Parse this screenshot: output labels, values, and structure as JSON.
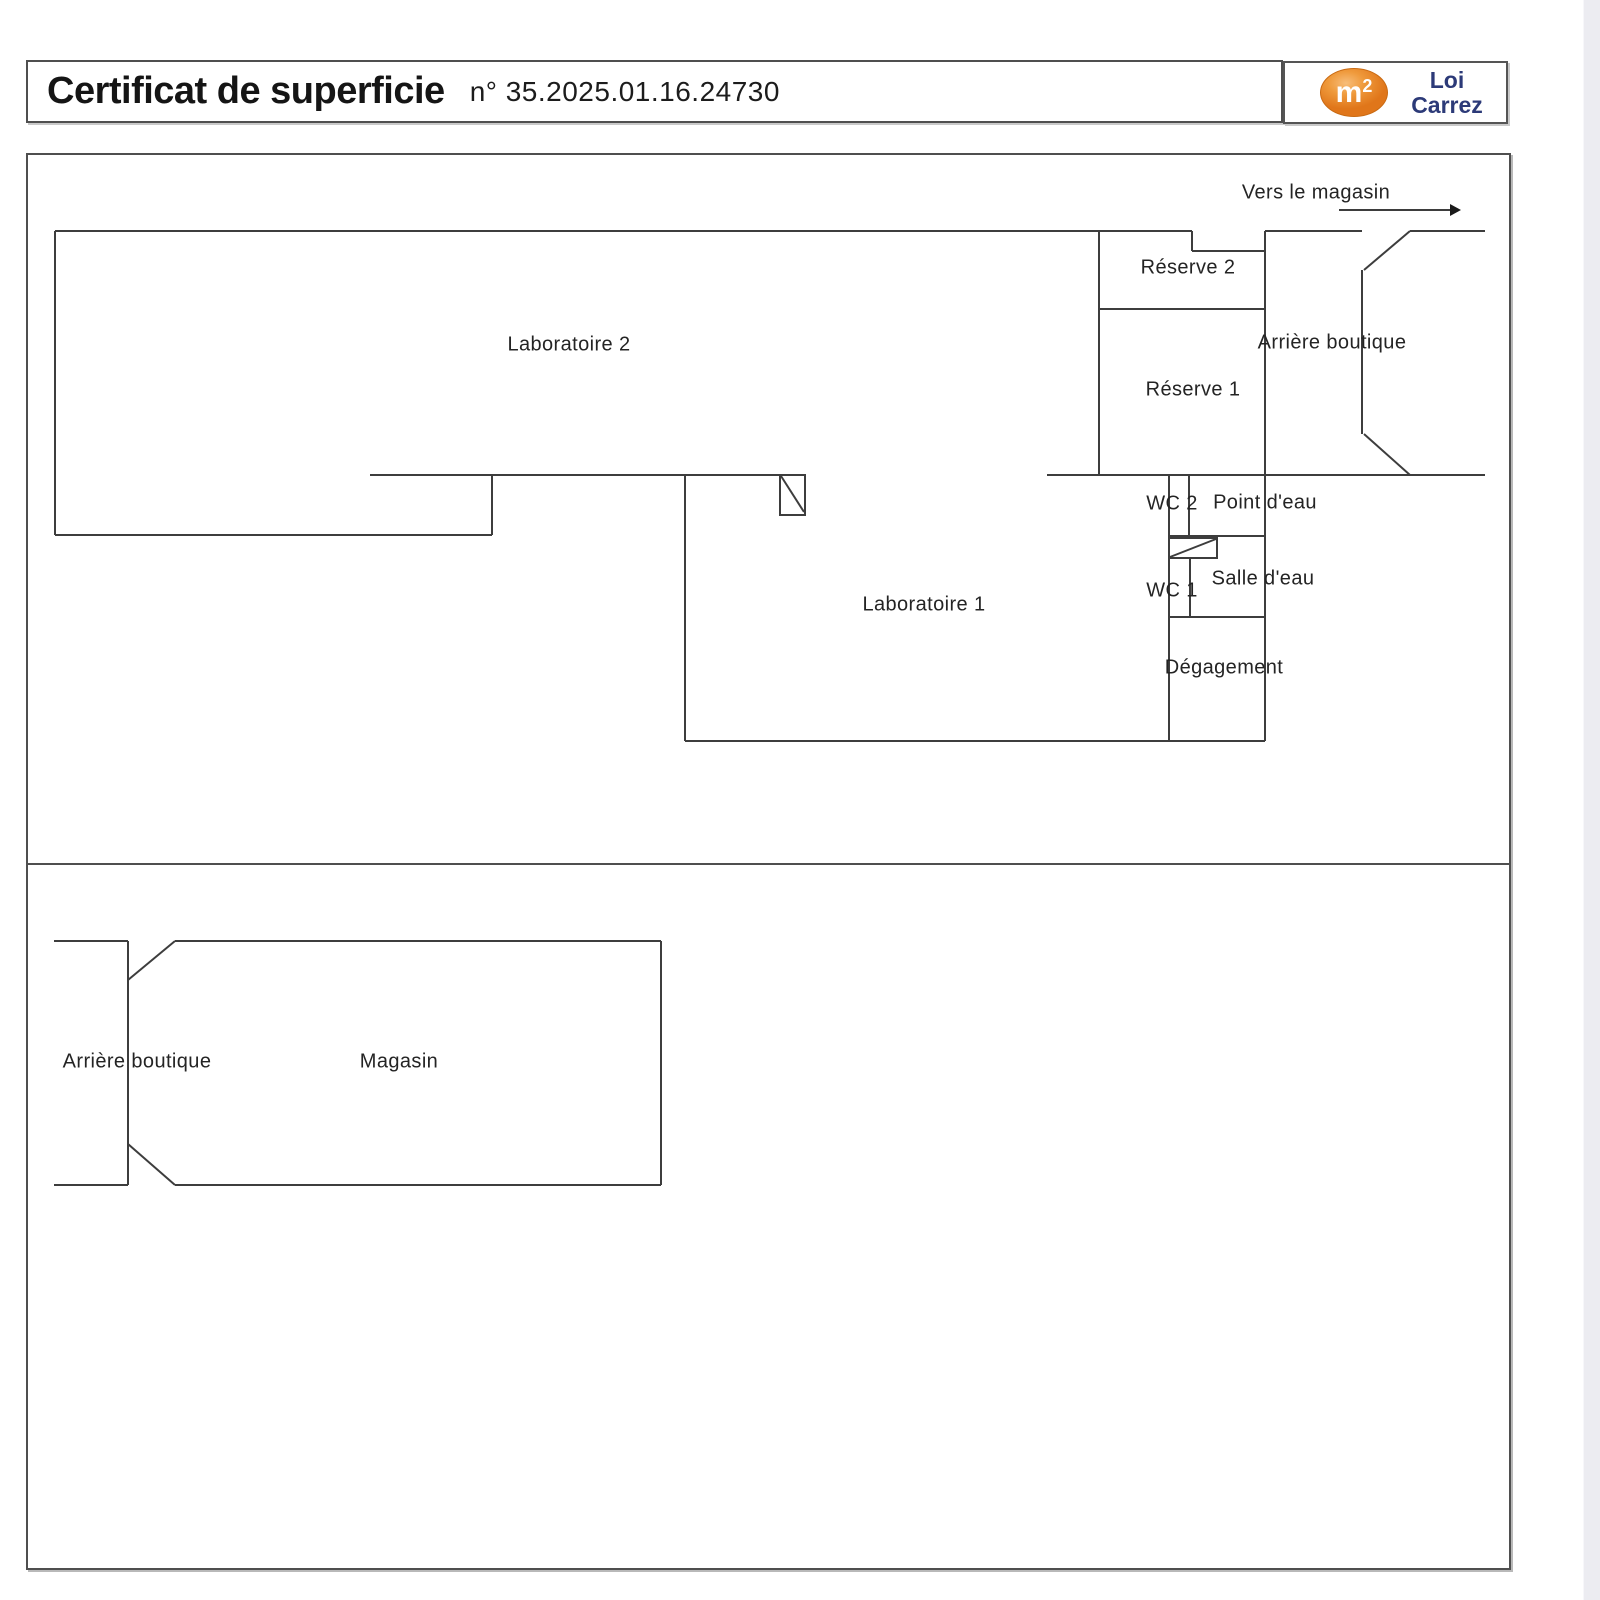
{
  "header": {
    "title": "Certificat de superficie",
    "number": "n° 35.2025.01.16.24730"
  },
  "logo": {
    "symbol_base": "m",
    "symbol_exp": "2",
    "line1": "Loi",
    "line2": "Carrez",
    "badge_color": "#e0761a",
    "text_color": "#2c3a78"
  },
  "floor_plan_upper": {
    "direction_label": "Vers le magasin",
    "rooms": {
      "laboratoire_2": "Laboratoire 2",
      "laboratoire_1": "Laboratoire 1",
      "reserve_2": "Réserve 2",
      "reserve_1": "Réserve 1",
      "arriere_boutique": "Arrière boutique",
      "wc_2": "WC 2",
      "point_d_eau": "Point d'eau",
      "wc_1": "WC 1",
      "salle_d_eau": "Salle d'eau",
      "degagement": "Dégagement"
    }
  },
  "floor_plan_lower": {
    "rooms": {
      "arriere_boutique": "Arrière boutique",
      "magasin": "Magasin"
    }
  },
  "colors": {
    "wall_line": "#3d3d3d",
    "page_edge_strip": "#ececf1"
  }
}
